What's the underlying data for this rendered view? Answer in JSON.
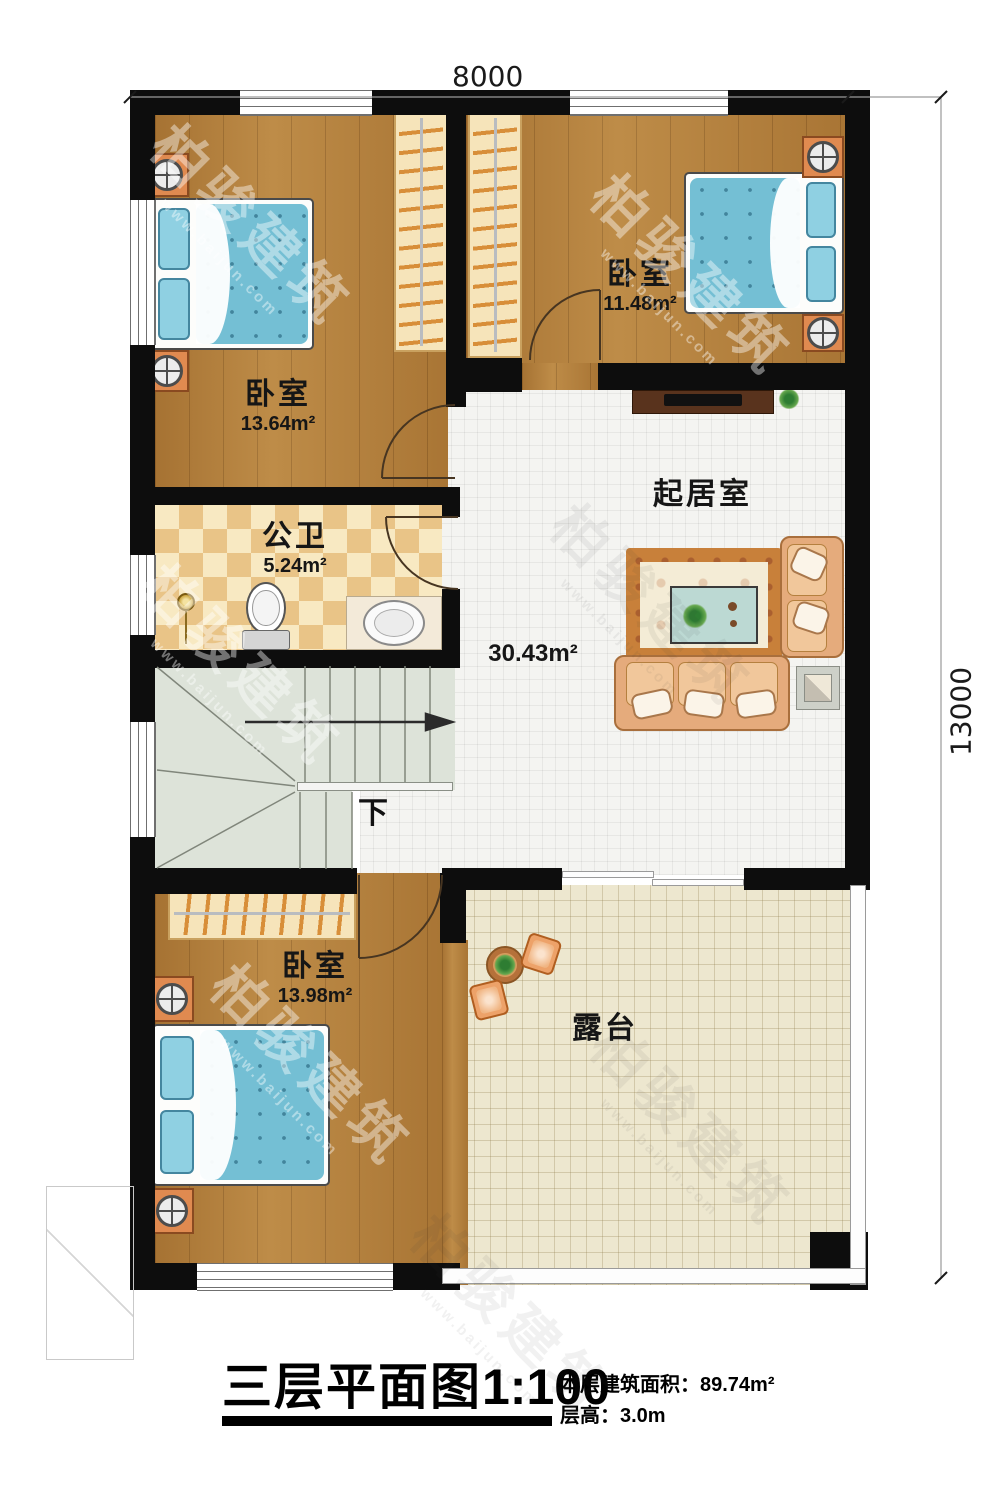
{
  "dimensions": {
    "top": "8000",
    "right": "13000"
  },
  "rooms": {
    "bedroom_tl": {
      "name": "卧室",
      "area": "13.64m²"
    },
    "bedroom_tr": {
      "name": "卧室",
      "area": "11.48m²"
    },
    "bathroom": {
      "name": "公卫",
      "area": "5.24m²"
    },
    "living": {
      "name": "起居室",
      "area": "30.43m²"
    },
    "bedroom_b": {
      "name": "卧室",
      "area": "13.98m²"
    },
    "terrace": {
      "name": "露台"
    }
  },
  "stairs": {
    "direction_label": "下"
  },
  "title_block": {
    "title": "三层平面图",
    "scale": "1:100",
    "floor_area_label": "本层建筑面积：",
    "floor_area_value": "89.74m²",
    "floor_height_label": "层高：",
    "floor_height_value": "3.0m"
  },
  "watermark": {
    "brand": "柏骏建筑",
    "site": "www.baijun.com"
  },
  "colors": {
    "wall": "#0d0d0d",
    "wood": "#b5813d",
    "mattress": "#74bfd4",
    "stair": "#dde3d9",
    "living_tile": "#f4f4f1",
    "terrace_tile": "#ede7cf",
    "bath_tile_dark": "#e9c487",
    "bath_tile_light": "#f8e9c2"
  }
}
